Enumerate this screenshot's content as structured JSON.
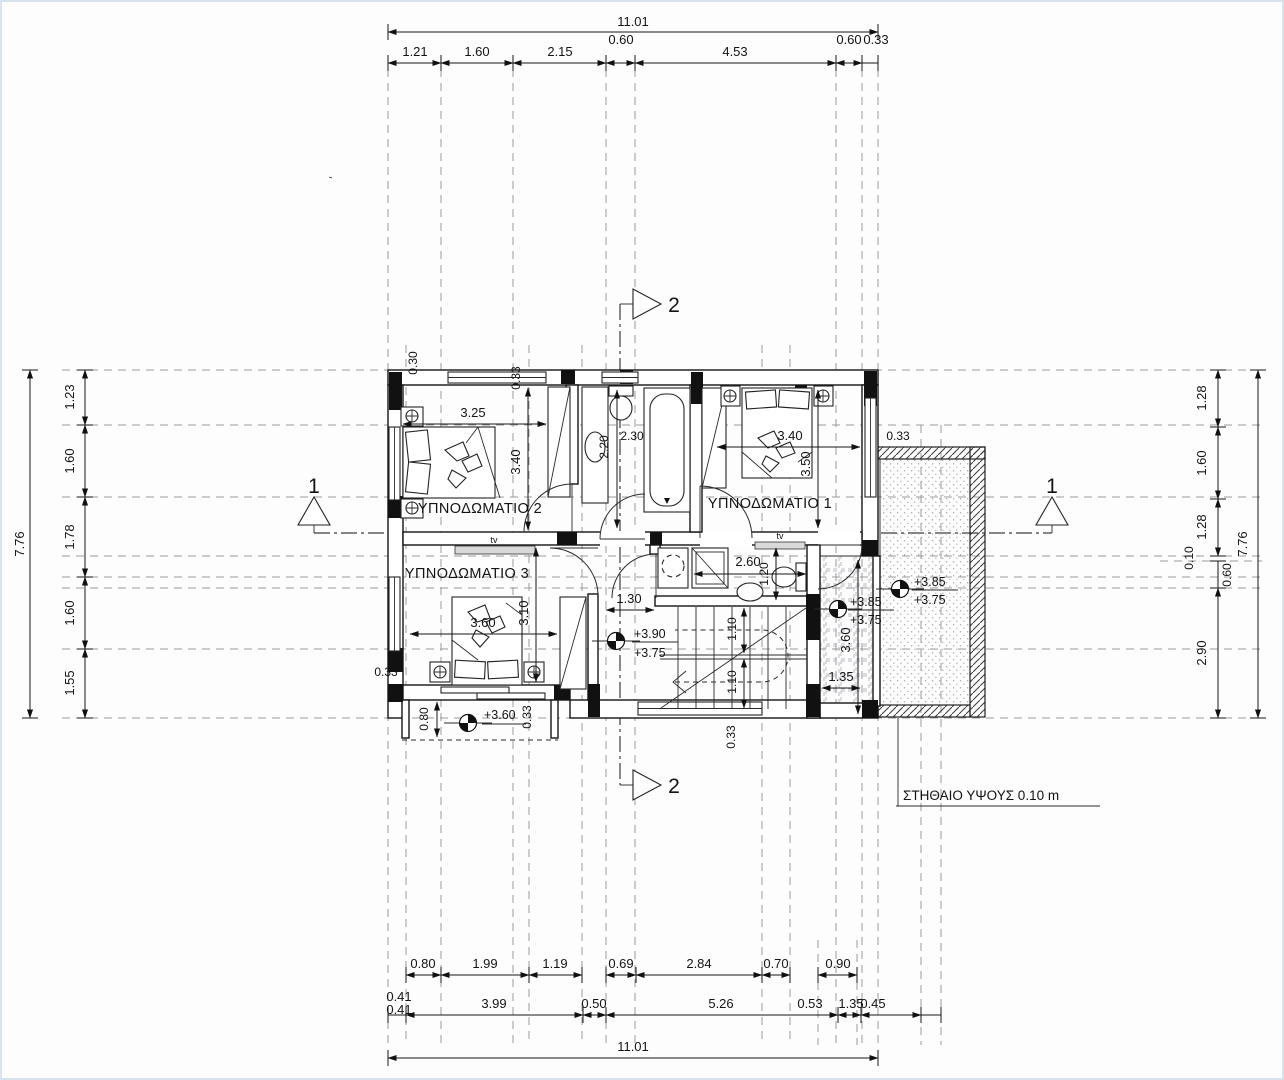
{
  "rooms": {
    "bedroom1": "ΥΠΝΟΔΩΜΑΤΙΟ 1",
    "bedroom2": "ΥΠΝΟΔΩΜΑΤΙΟ 2",
    "bedroom3": "ΥΠΝΟΔΩΜΑΤΙΟ 3"
  },
  "notes": {
    "parapet": "ΣΤΗΘΑΙΟ ΥΨΟΥΣ 0.10 m",
    "tv": "tv"
  },
  "sections": {
    "one": "1",
    "two": "2"
  },
  "levels": {
    "hall_top": "+3.90",
    "hall_bot": "+3.75",
    "terr_top": "+3.85",
    "terr_bot": "+3.75",
    "balc_top": "+3.85",
    "balc_bot": "+3.75",
    "small": "+3.60"
  },
  "dims": {
    "overall_w": "11.01",
    "overall_h": "7.76",
    "top": [
      "1.21",
      "1.60",
      "2.15",
      "0.60",
      "4.53",
      "0.60",
      "0.33"
    ],
    "left": [
      "1.23",
      "1.60",
      "1.78",
      "1.60",
      "1.55"
    ],
    "right": [
      "1.28",
      "1.60",
      "1.28",
      "0.10",
      "0.60",
      "2.90"
    ],
    "bottom_r1": [
      "0.80",
      "1.99",
      "1.19",
      "0.69",
      "2.84",
      "0.70",
      "0.90"
    ],
    "bottom_r2": [
      "0.41",
      "3.99",
      "0.50",
      "5.26",
      "0.53",
      "1.35",
      "0.45"
    ],
    "stack041": "0.41",
    "interior": {
      "bed2_w": "3.25",
      "bed2_h": "3.40",
      "bath_d": "2.20",
      "bath_d2": "2.30",
      "bed1_w": "3.40",
      "bed1_h": "3.50",
      "bed3_w": "3.60",
      "bed3_h": "3.10",
      "wc_w": "2.60",
      "wc_d": "1.20",
      "hall_w": "1.30",
      "stair_a": "1.10",
      "stair_b": "1.10",
      "terr_h": "3.60",
      "terr_w": "1.35",
      "w030": "0.30",
      "w033": "0.33",
      "balc_h": "0.80"
    }
  }
}
